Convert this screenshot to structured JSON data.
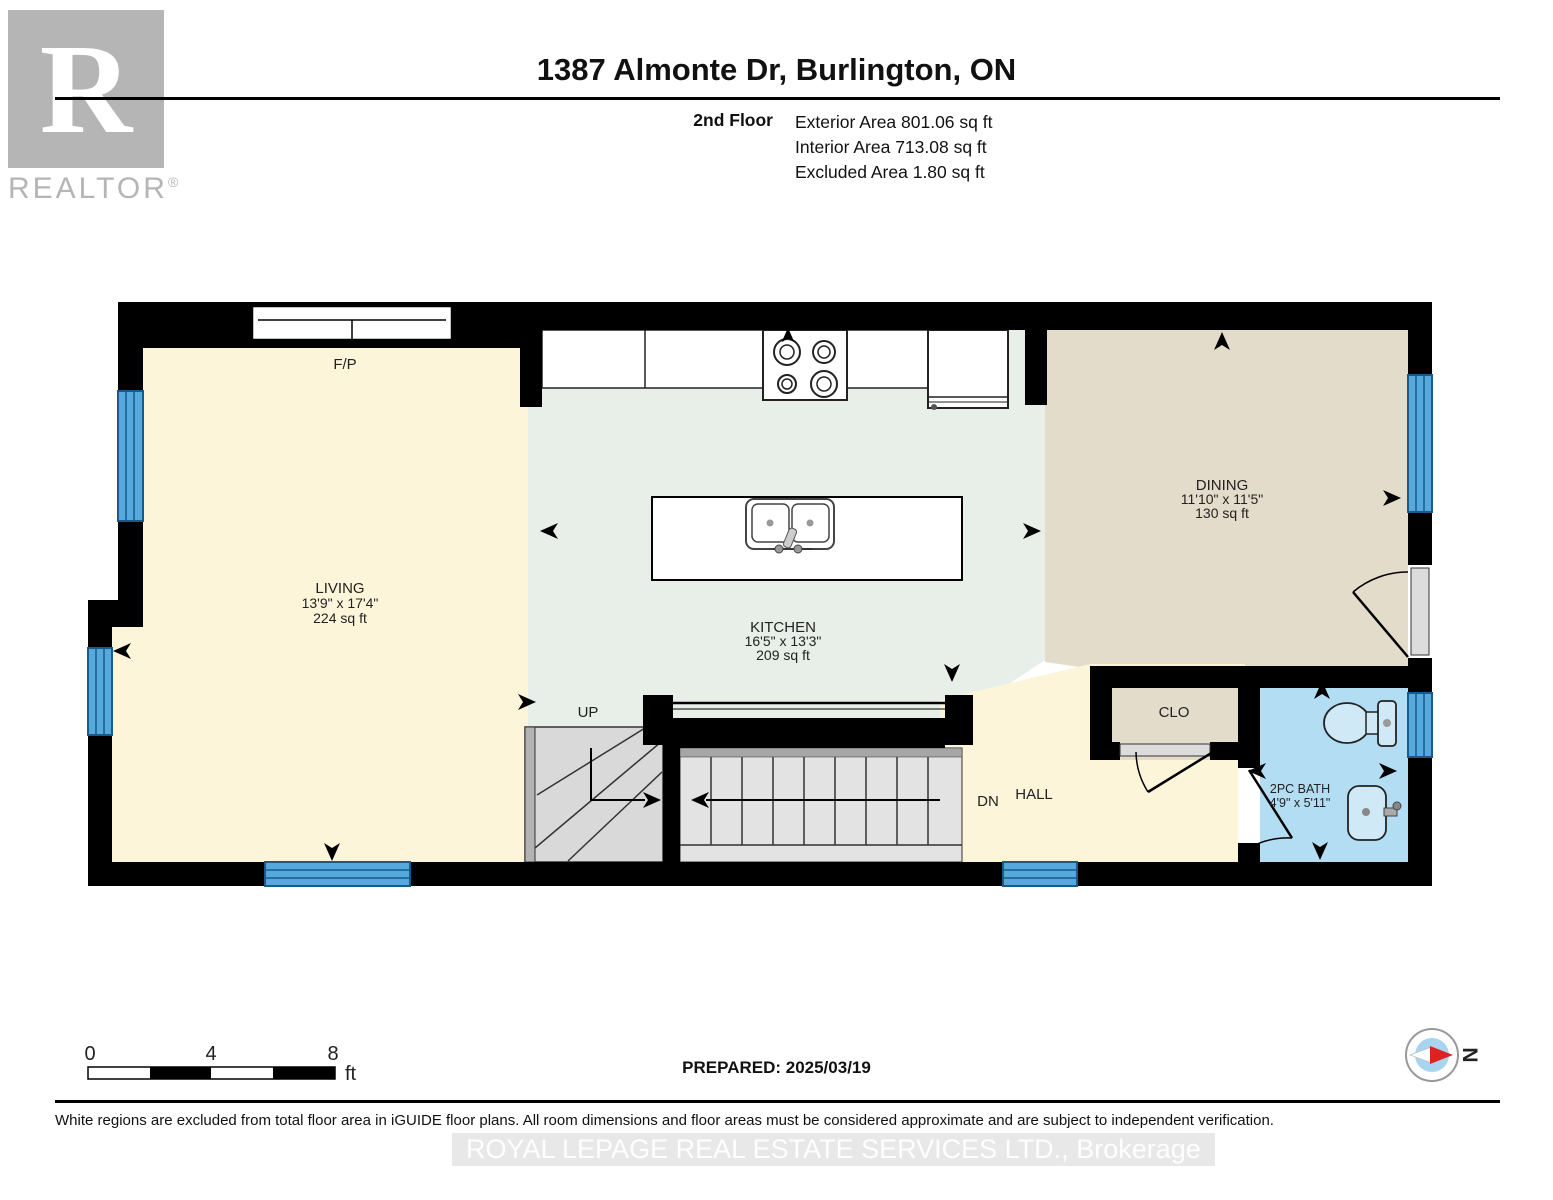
{
  "logo": {
    "r": "R",
    "realtor": "REALTOR",
    "registered": "®"
  },
  "header": {
    "title": "1387 Almonte Dr, Burlington, ON",
    "floor_label": "2nd Floor",
    "area_lines": [
      "Exterior Area 801.06 sq ft",
      "Interior Area 713.08 sq ft",
      "Excluded Area 1.80 sq ft"
    ]
  },
  "rooms": {
    "living": {
      "name": "LIVING",
      "dims": "13'9\" x 17'4\"",
      "area": "224 sq ft"
    },
    "kitchen": {
      "name": "KITCHEN",
      "dims": "16'5\" x 13'3\"",
      "area": "209 sq ft"
    },
    "dining": {
      "name": "DINING",
      "dims": "11'10\" x 11'5\"",
      "area": "130 sq ft"
    },
    "bath": {
      "name": "2PC BATH",
      "dims": "4'9\" x 5'11\""
    },
    "hall": {
      "name": "HALL"
    },
    "closet": {
      "name": "CLO"
    },
    "fireplace": {
      "name": "F/P"
    },
    "stair_up": {
      "name": "UP"
    },
    "stair_down": {
      "name": "DN"
    }
  },
  "scale_bar": {
    "ticks": [
      "0",
      "4",
      "8"
    ],
    "unit": "ft"
  },
  "compass": {
    "north": "N"
  },
  "footer": {
    "prepared": "PREPARED: 2025/03/19",
    "disclaimer": "White regions are excluded from total floor area in iGUIDE floor plans. All room dimensions and floor areas must be considered approximate and are subject to independent verification.",
    "watermark": "ROYAL LEPAGE REAL ESTATE SERVICES LTD., Brokerage"
  },
  "colors": {
    "living": "#fcf5da",
    "kitchen": "#e7efe8",
    "dining": "#e4dccb",
    "closet": "#e4dccb",
    "hall": "#fcf5da",
    "bath": "#b3ddf2",
    "window": "#55a9dd",
    "wall": "#000000"
  }
}
